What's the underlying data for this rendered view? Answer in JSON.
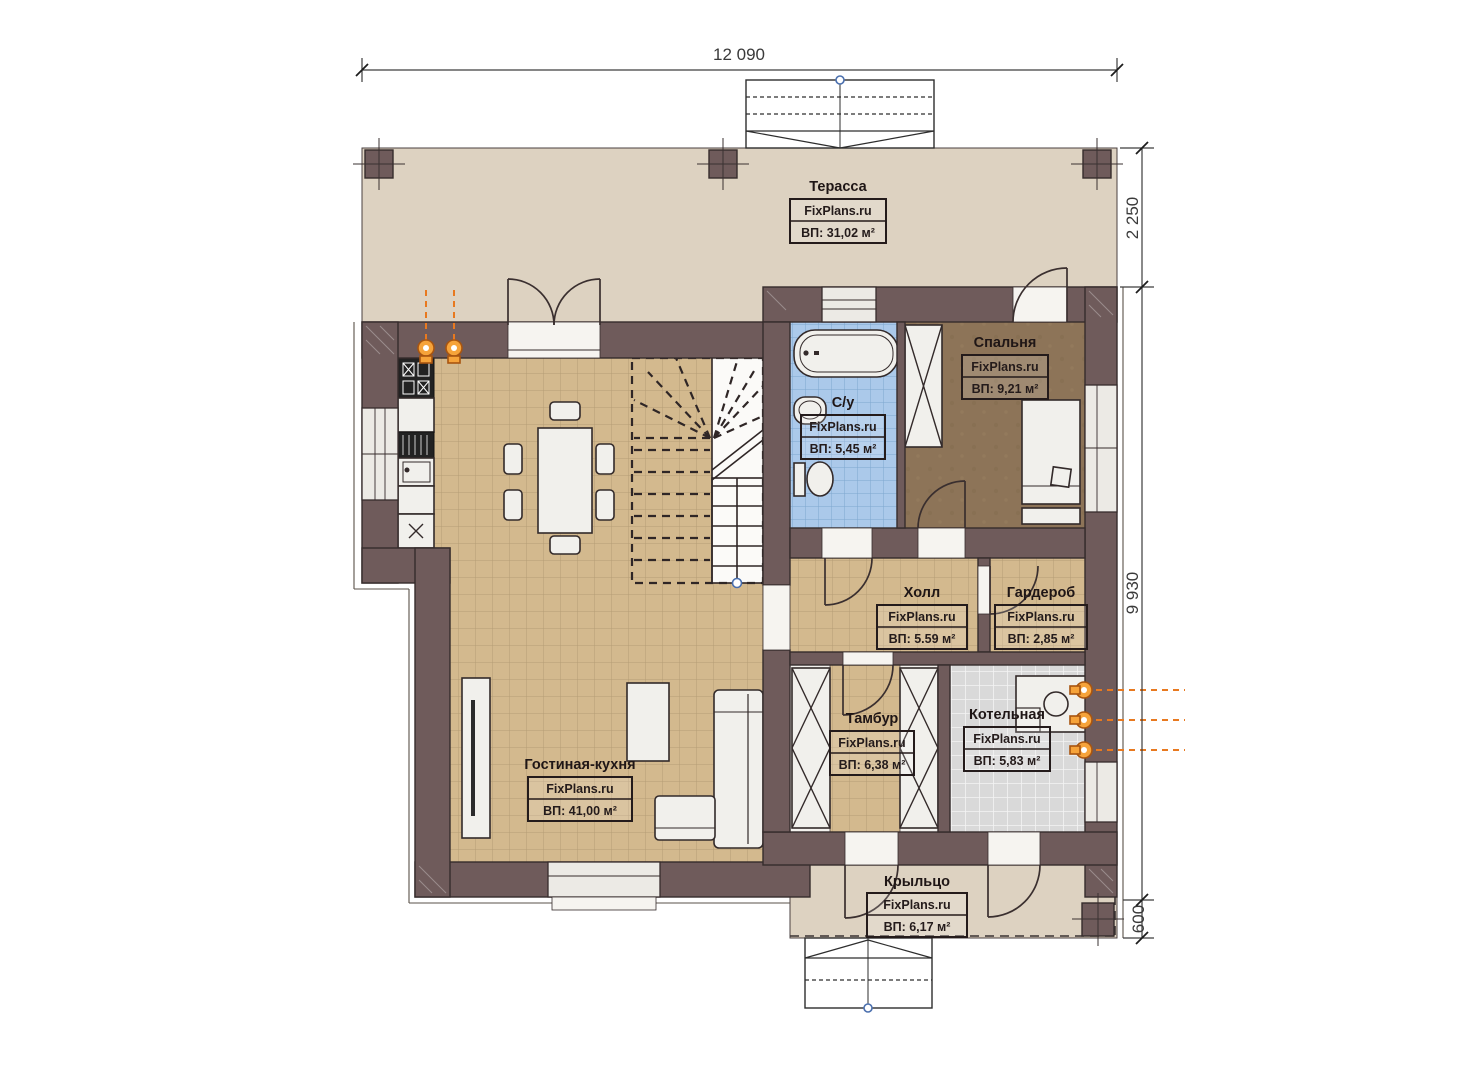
{
  "plan": {
    "watermark": "FixPlans.ru",
    "dimensions": {
      "width_total": "12 090",
      "terrace_depth": "2 250",
      "house_depth": "9 930",
      "porch_depth": "600"
    },
    "rooms": [
      {
        "id": "terrace",
        "name": "Терасса",
        "area": "ВП: 31,02 м²"
      },
      {
        "id": "bedroom",
        "name": "Спальня",
        "area": "ВП: 9,21 м²"
      },
      {
        "id": "bathroom",
        "name": "С/у",
        "area": "ВП: 5,45 м²"
      },
      {
        "id": "hall",
        "name": "Холл",
        "area": "ВП: 5.59 м²"
      },
      {
        "id": "wardrobe",
        "name": "Гардероб",
        "area": "ВП: 2,85 м²"
      },
      {
        "id": "vestibule",
        "name": "Тамбур",
        "area": "ВП: 6,38 м²"
      },
      {
        "id": "boiler",
        "name": "Котельная",
        "area": "ВП: 5,83 м²"
      },
      {
        "id": "living",
        "name": "Гостиная-кухня",
        "area": "ВП: 41,00 м²"
      },
      {
        "id": "porch",
        "name": "Крыльцо",
        "area": "ВП: 6,17 м²"
      }
    ],
    "colors": {
      "wall": "#6f5b5b",
      "terrace_floor": "#ddd2c1",
      "tile_tan": "#d3b98e",
      "tile_blue": "#abc9ea",
      "tile_gray": "#d9d9d9",
      "bedroom_floor": "#8d7458",
      "accent_orange": "#e8791f"
    }
  }
}
